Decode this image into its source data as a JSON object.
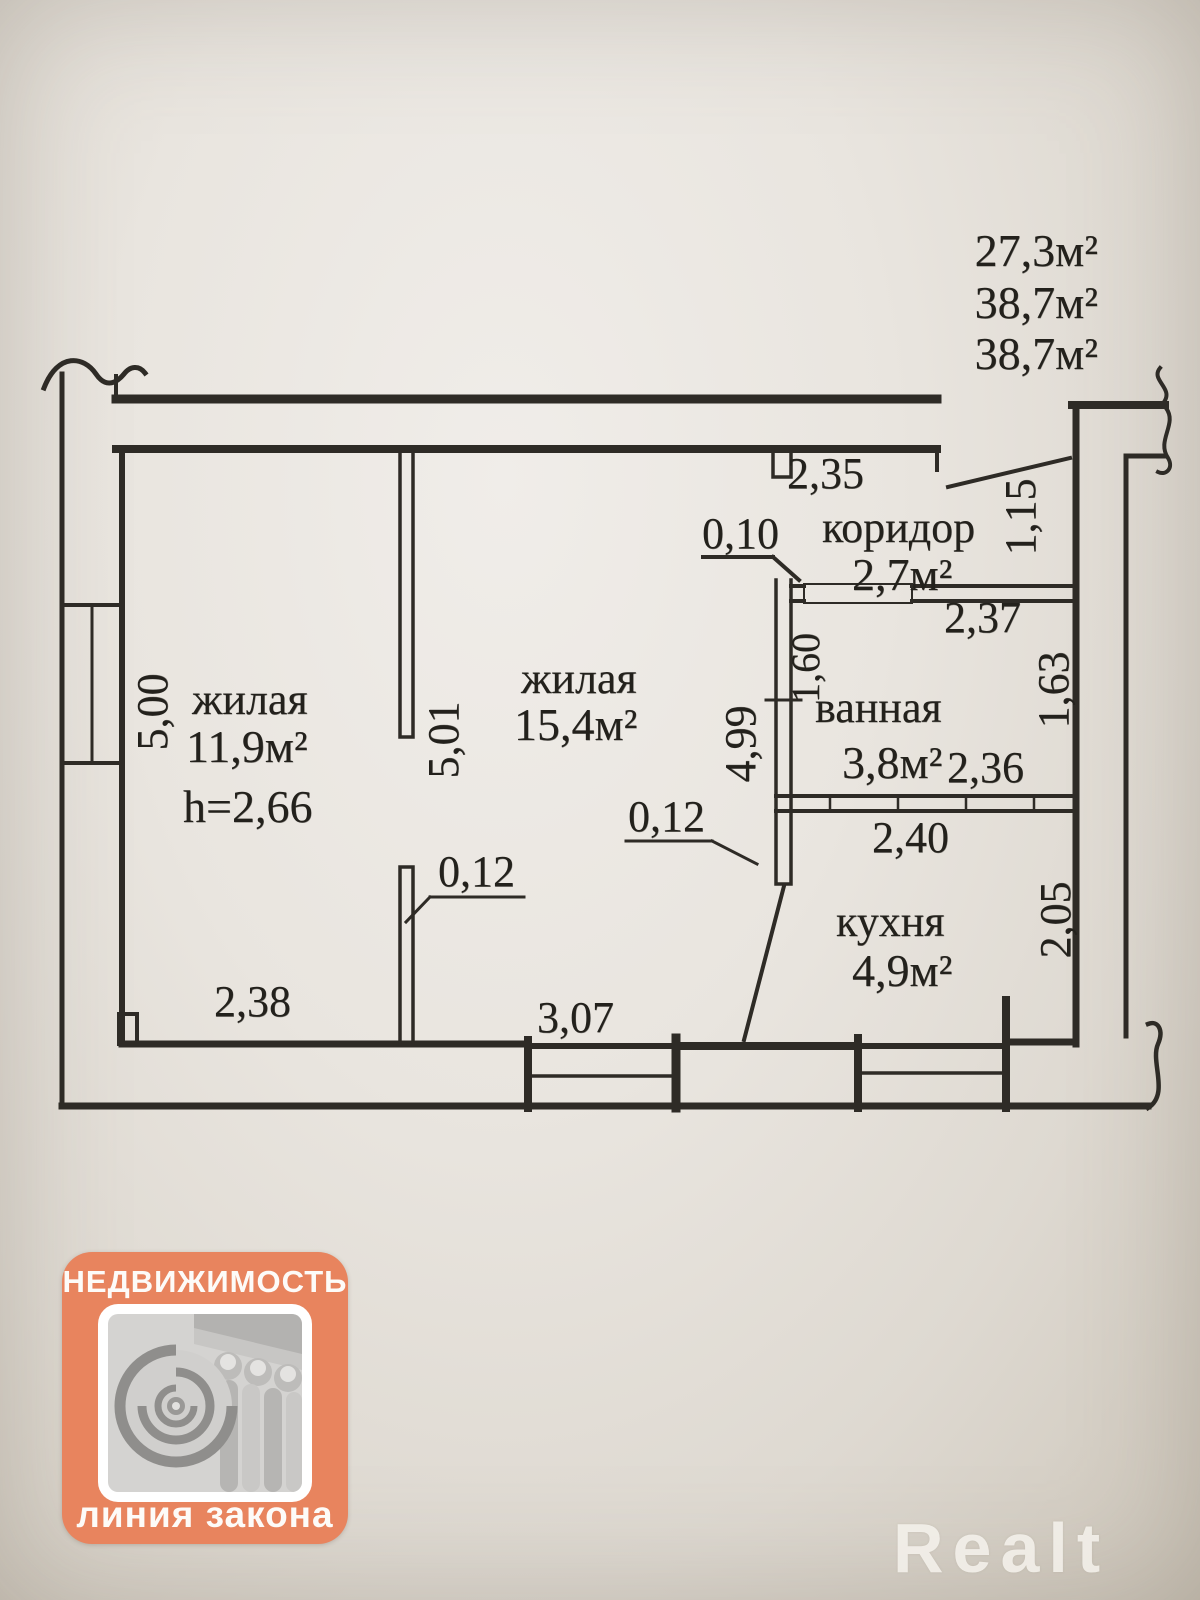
{
  "document_type": "apartment floor plan scan",
  "summary": {
    "line1": "27,3м²",
    "line2": "38,7м²",
    "line3": "38,7м²"
  },
  "rooms": [
    {
      "name": "жилая",
      "area": "11,9м²",
      "height": "h=2,66"
    },
    {
      "name": "жилая",
      "area": "15,4м²"
    },
    {
      "name": "коридор",
      "area": "2,7м²"
    },
    {
      "name": "ванная",
      "area": "3,8м²"
    },
    {
      "name": "кухня",
      "area": "4,9м²"
    }
  ],
  "labels": {
    "summary_1": "27,3м²",
    "summary_2": "38,7м²",
    "summary_3": "38,7м²",
    "room1_name": "жилая",
    "room1_area": "11,9м²",
    "room1_height": "h=2,66",
    "room2_name": "жилая",
    "room2_area": "15,4м²",
    "corridor_name": "коридор",
    "corridor_area": "2,7м²",
    "bath_name": "ванная",
    "bath_area": "3,8м²",
    "kitchen_name": "кухня",
    "kitchen_area": "4,9м²",
    "dim_235": "2,35",
    "dim_010": "0,10",
    "dim_115": "1,15",
    "dim_237": "2,37",
    "dim_160": "1,60",
    "dim_163": "1,63",
    "dim_236": "2,36",
    "dim_240": "2,40",
    "dim_205": "2,05",
    "dim_500": "5,00",
    "dim_501": "5,01",
    "dim_499": "4,99",
    "dim_012_mid": "0,12",
    "dim_012_left": "0,12",
    "dim_238": "2,38",
    "dim_307": "3,07"
  },
  "logo": {
    "title": "НЕДВИЖИМОСТЬ",
    "subtitle": "линия закона",
    "accent_color": "#e8845e"
  },
  "watermark": "Realt",
  "ink_color": "#2e2b26",
  "paper_color": "#e9e5df"
}
